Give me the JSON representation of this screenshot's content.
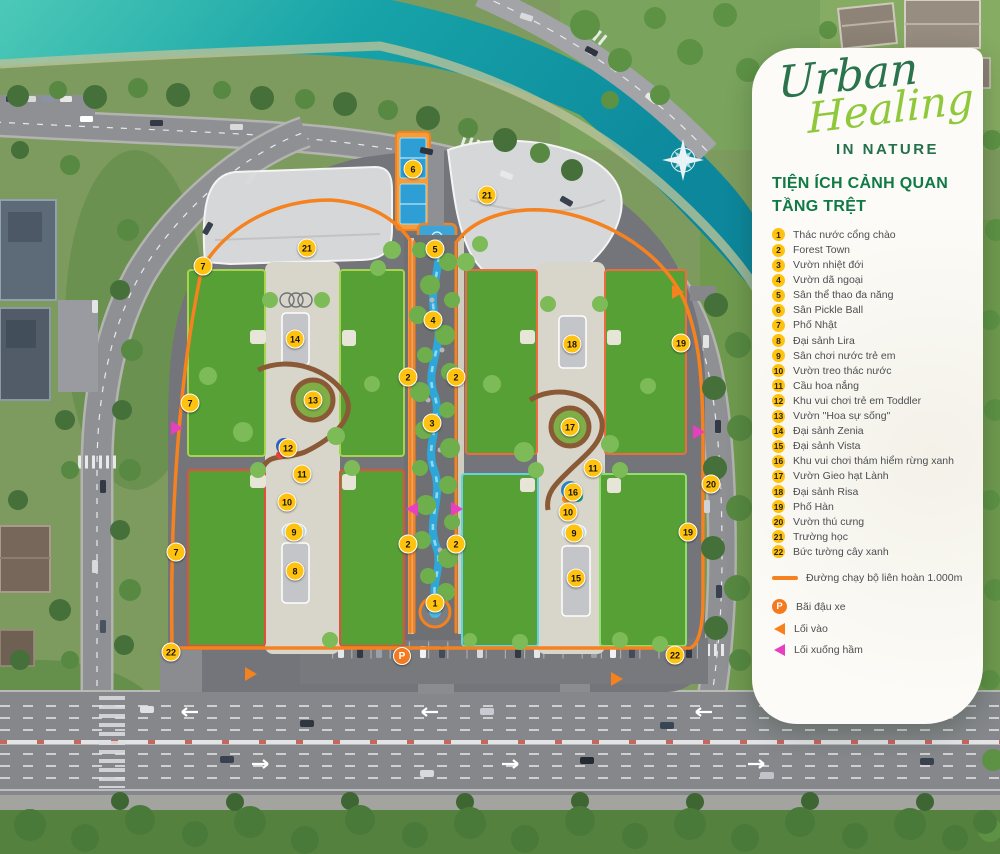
{
  "branding": {
    "word1": "Urban",
    "word2": "Healing",
    "word3": "IN NATURE"
  },
  "legend": {
    "title": [
      "TIỆN ÍCH CẢNH QUAN",
      "TẦNG TRỆT"
    ],
    "items": [
      {
        "num": "1",
        "label": "Thác nước cổng chào"
      },
      {
        "num": "2",
        "label": "Forest Town"
      },
      {
        "num": "3",
        "label": "Vườn nhiệt đới"
      },
      {
        "num": "4",
        "label": "Vườn dã ngoại"
      },
      {
        "num": "5",
        "label": "Sân thể thao đa năng"
      },
      {
        "num": "6",
        "label": "Sân Pickle Ball"
      },
      {
        "num": "7",
        "label": "Phố Nhật"
      },
      {
        "num": "8",
        "label": "Đại sảnh Lira"
      },
      {
        "num": "9",
        "label": "Sân chơi nước trẻ em"
      },
      {
        "num": "10",
        "label": "Vườn treo thác nước"
      },
      {
        "num": "11",
        "label": "Cầu hoa nắng"
      },
      {
        "num": "12",
        "label": "Khu vui chơi trẻ em Toddler"
      },
      {
        "num": "13",
        "label": "Vườn \"Hoa sự sống\""
      },
      {
        "num": "14",
        "label": "Đại sảnh Zenia"
      },
      {
        "num": "15",
        "label": "Đại sảnh Vista"
      },
      {
        "num": "16",
        "label": "Khu vui chơi thám hiểm rừng xanh"
      },
      {
        "num": "17",
        "label": "Vườn Gieo hạt Lành"
      },
      {
        "num": "18",
        "label": "Đại sảnh Risa"
      },
      {
        "num": "19",
        "label": "Phố Hàn"
      },
      {
        "num": "20",
        "label": "Vườn thú cưng"
      },
      {
        "num": "21",
        "label": "Trường học"
      },
      {
        "num": "22",
        "label": "Bức tường cây xanh"
      }
    ],
    "route_note": "Đường chạy bộ liên hoàn 1.000m",
    "symbols": [
      {
        "kind": "parking",
        "glyph": "P",
        "label": "Bãi đậu xe"
      },
      {
        "kind": "entry",
        "label": "Lối vào"
      },
      {
        "kind": "basement-entry",
        "label": "Lối  xuống hầm"
      }
    ]
  },
  "map": {
    "markers": [
      {
        "num": "1",
        "x": 435,
        "y": 603
      },
      {
        "num": "2",
        "x": 408,
        "y": 377
      },
      {
        "num": "2",
        "x": 456,
        "y": 377
      },
      {
        "num": "2",
        "x": 408,
        "y": 544
      },
      {
        "num": "2",
        "x": 456,
        "y": 544
      },
      {
        "num": "3",
        "x": 432,
        "y": 423
      },
      {
        "num": "4",
        "x": 433,
        "y": 320
      },
      {
        "num": "5",
        "x": 435,
        "y": 249
      },
      {
        "num": "6",
        "x": 413,
        "y": 169
      },
      {
        "num": "7",
        "x": 203,
        "y": 266
      },
      {
        "num": "7",
        "x": 190,
        "y": 403
      },
      {
        "num": "7",
        "x": 176,
        "y": 552
      },
      {
        "num": "8",
        "x": 295,
        "y": 571
      },
      {
        "num": "9",
        "x": 294,
        "y": 532
      },
      {
        "num": "9",
        "x": 574,
        "y": 533
      },
      {
        "num": "10",
        "x": 287,
        "y": 502
      },
      {
        "num": "10",
        "x": 568,
        "y": 512
      },
      {
        "num": "11",
        "x": 302,
        "y": 474
      },
      {
        "num": "11",
        "x": 593,
        "y": 468
      },
      {
        "num": "12",
        "x": 288,
        "y": 448
      },
      {
        "num": "13",
        "x": 313,
        "y": 400
      },
      {
        "num": "14",
        "x": 295,
        "y": 339
      },
      {
        "num": "15",
        "x": 576,
        "y": 578
      },
      {
        "num": "16",
        "x": 573,
        "y": 492
      },
      {
        "num": "17",
        "x": 570,
        "y": 427
      },
      {
        "num": "18",
        "x": 572,
        "y": 344
      },
      {
        "num": "19",
        "x": 681,
        "y": 343
      },
      {
        "num": "19",
        "x": 688,
        "y": 532
      },
      {
        "num": "20",
        "x": 711,
        "y": 484
      },
      {
        "num": "21",
        "x": 307,
        "y": 248
      },
      {
        "num": "21",
        "x": 487,
        "y": 195
      },
      {
        "num": "22",
        "x": 171,
        "y": 652
      },
      {
        "num": "22",
        "x": 675,
        "y": 655
      }
    ],
    "parking": {
      "glyph": "P",
      "x": 402,
      "y": 656
    },
    "arrows": [
      {
        "color": "#f5821f",
        "dir": "right",
        "x": 251,
        "y": 674
      },
      {
        "color": "#f5821f",
        "dir": "right",
        "x": 617,
        "y": 679
      },
      {
        "color": "#f5821f",
        "dir": "right",
        "x": 678,
        "y": 292
      },
      {
        "color": "#e83fc0",
        "dir": "right",
        "x": 177,
        "y": 428
      },
      {
        "color": "#e83fc0",
        "dir": "left",
        "x": 412,
        "y": 509
      },
      {
        "color": "#e83fc0",
        "dir": "right",
        "x": 457,
        "y": 509
      },
      {
        "color": "#e83fc0",
        "dir": "right",
        "x": 699,
        "y": 432
      }
    ]
  },
  "colors": {
    "marker_bg": "#ffc20e",
    "orange": "#f5821f",
    "pink": "#e83fc0",
    "green_dark": "#23704a",
    "green_light": "#8fc83a",
    "water": "#14a0a6"
  }
}
